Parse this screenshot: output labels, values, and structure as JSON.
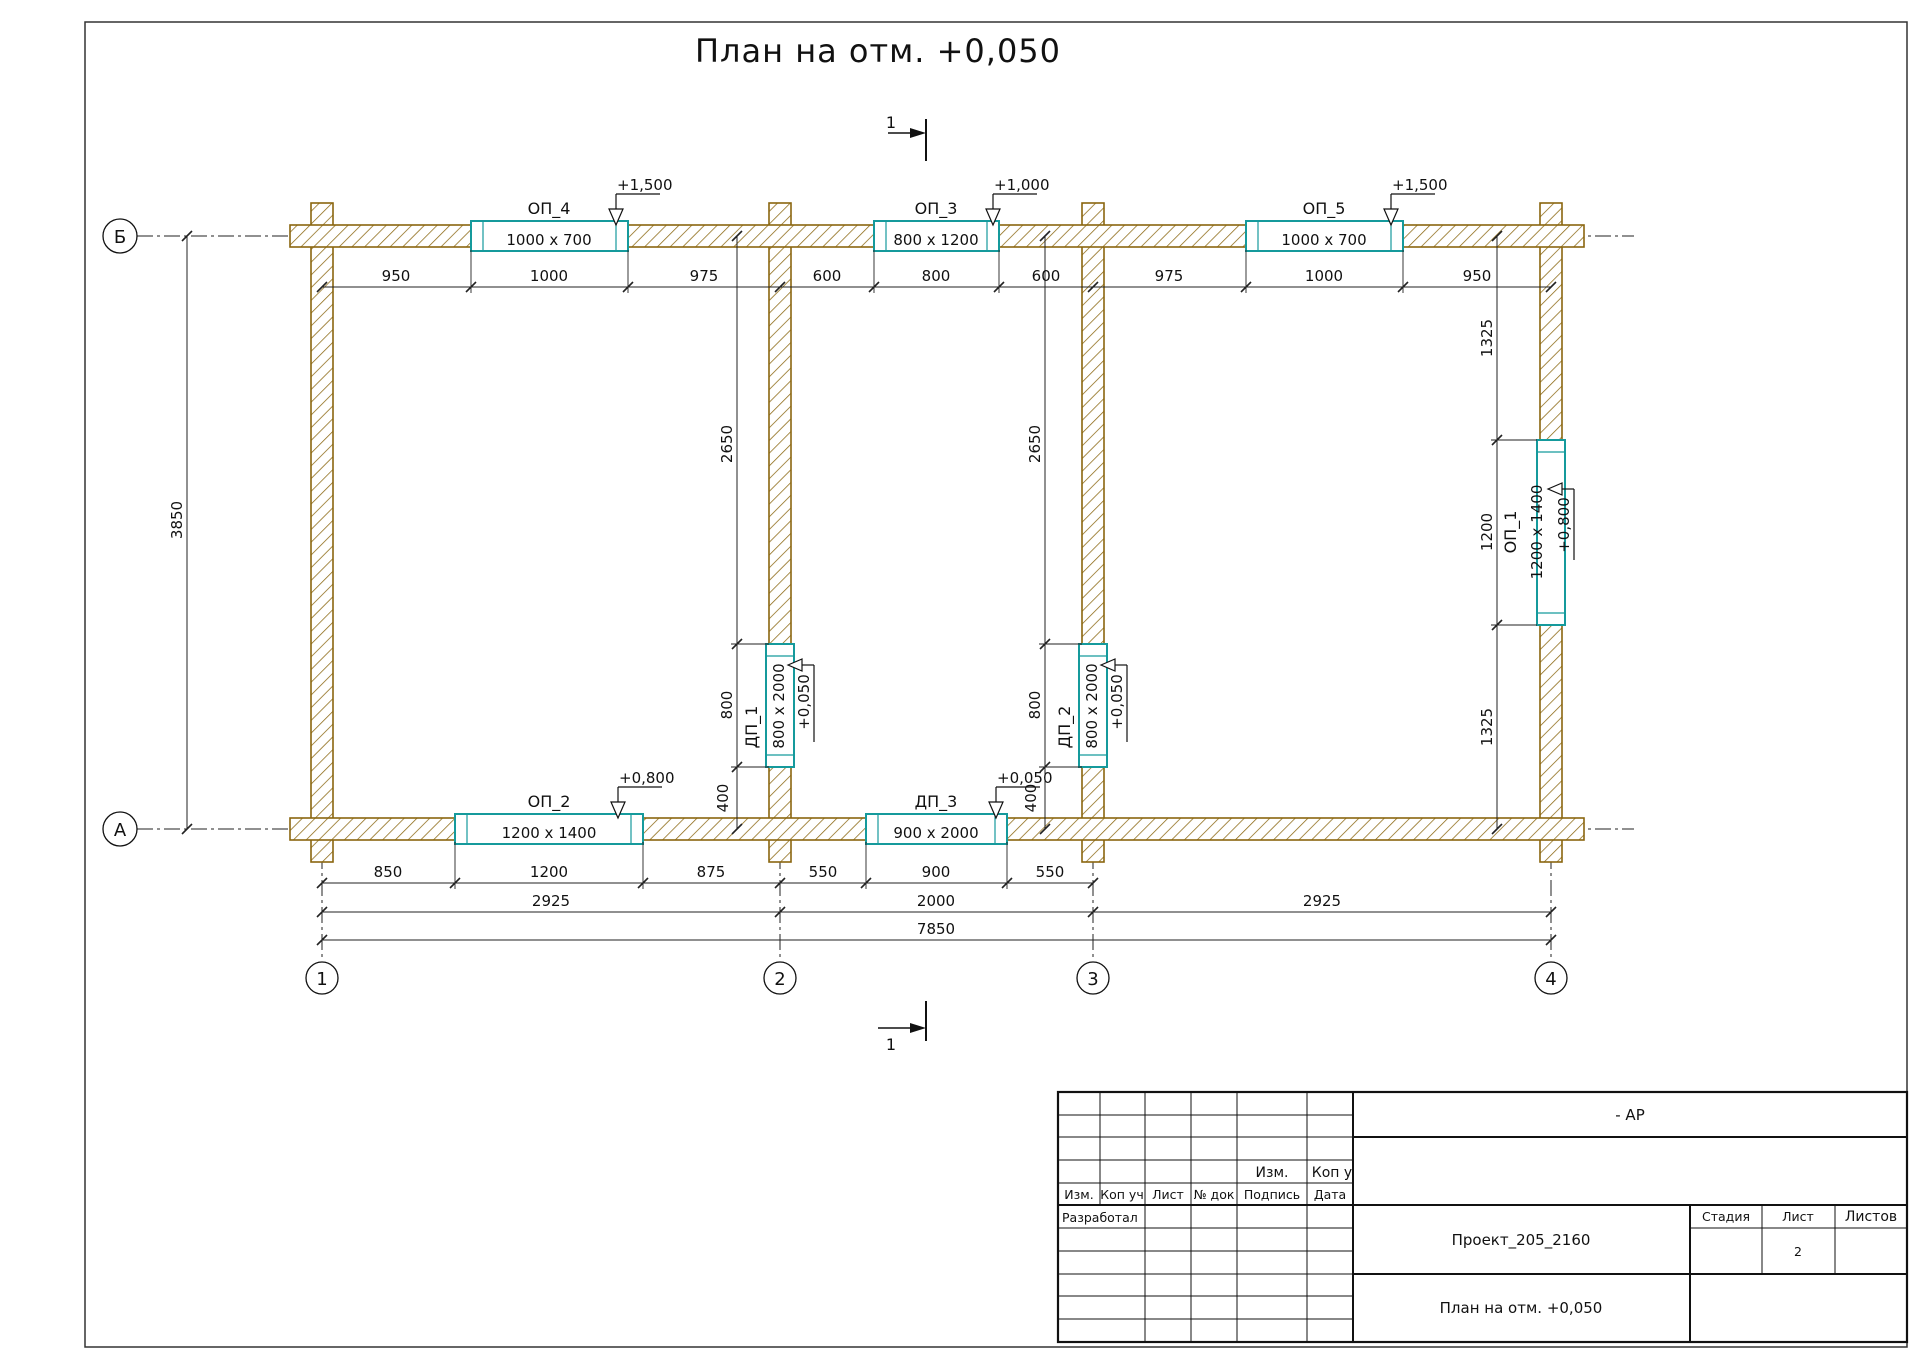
{
  "title": "План на отм. +0,050",
  "section_label": "1",
  "axes": {
    "rows": [
      "Б",
      "А"
    ],
    "cols": [
      "1",
      "2",
      "3",
      "4"
    ]
  },
  "dims": {
    "top": [
      "950",
      "1000",
      "975",
      "600",
      "800",
      "600",
      "975",
      "1000",
      "950"
    ],
    "bottom1": [
      "850",
      "1200",
      "875",
      "550",
      "900",
      "550"
    ],
    "bottom2": [
      "2925",
      "2000",
      "2925"
    ],
    "total": "7850",
    "left": "3850",
    "right": [
      "1325",
      "1200",
      "1325"
    ],
    "wall2": [
      "2650",
      "800",
      "400"
    ],
    "wall3": [
      "2650",
      "800",
      "400"
    ]
  },
  "openings": {
    "op4": {
      "label": "ОП_4",
      "size": "1000 x 700",
      "elev": "+1,500"
    },
    "op3": {
      "label": "ОП_3",
      "size": "800 x 1200",
      "elev": "+1,000"
    },
    "op5": {
      "label": "ОП_5",
      "size": "1000 x 700",
      "elev": "+1,500"
    },
    "op2": {
      "label": "ОП_2",
      "size": "1200 x 1400",
      "elev": "+0,800"
    },
    "op1": {
      "label": "ОП_1",
      "size": "1200 x 1400",
      "elev": "+0,800"
    },
    "dp1": {
      "label": "ДП_1",
      "size": "800 x 2000",
      "elev": "+0,050"
    },
    "dp2": {
      "label": "ДП_2",
      "size": "800 x 2000",
      "elev": "+0,050"
    },
    "dp3": {
      "label": "ДП_3",
      "size": "900 x 2000",
      "elev": "+0,050"
    }
  },
  "colors": {
    "wall": "#8a660f",
    "opening": "#159a9c",
    "line": "#1c1c1c"
  },
  "title_block": {
    "ap": "- АР",
    "rev_small": [
      "Изм.",
      "Коп у"
    ],
    "header": [
      "Изм.",
      "Коп уч",
      "Лист",
      "№ док",
      "Подпись",
      "Дата"
    ],
    "developed": "Разработал",
    "project": "Проект_205_2160",
    "stage": "Стадия",
    "sheet": "Лист",
    "sheets": "Листов",
    "sheet_no": "2",
    "doc_title": "План на отм. +0,050"
  }
}
